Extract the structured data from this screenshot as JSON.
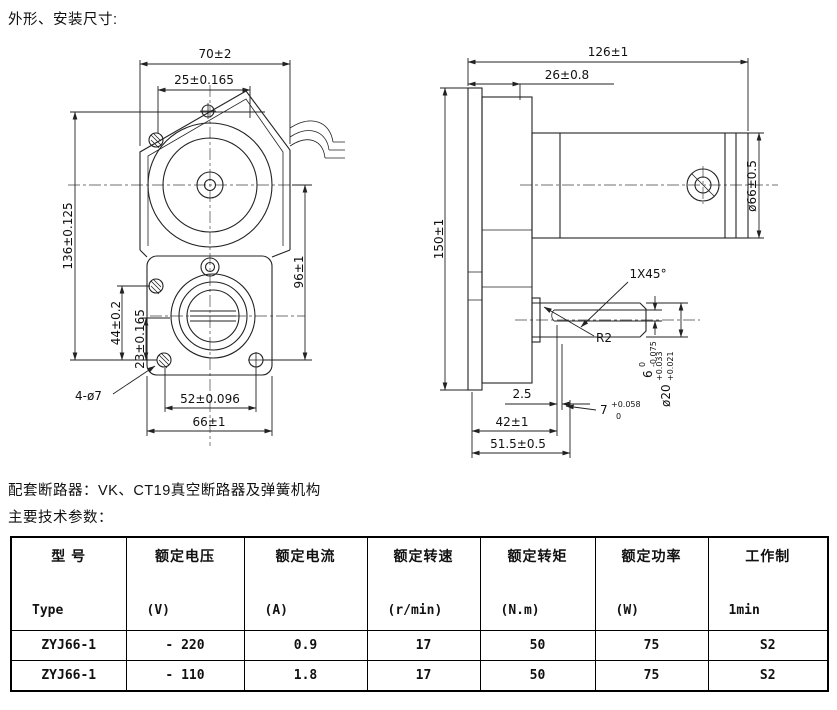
{
  "page": {
    "title": "外形、安装尺寸:",
    "breaker_note": "配套断路器：VK、CT19真空断路器及弹簧机构",
    "params_heading": "主要技术参数："
  },
  "drawing": {
    "front_view": {
      "dim_width_top": "70±2",
      "dim_hole_top": "25±0.165",
      "dim_height": "136±0.125",
      "dim_44": "44±0.2",
      "dim_23": "23±0.165",
      "dim_96": "96±1",
      "holes_note": "4-ø7",
      "dim_52": "52±0.096",
      "dim_66": "66±1"
    },
    "side_view": {
      "dim_length": "126±1",
      "dim_26": "26±0.8",
      "dim_150": "150±1",
      "dim_dia66": "ø66±0.5",
      "chamfer": "1X45°",
      "fillet": "R2",
      "dim_2_5": "2.5",
      "dim_42": "42±1",
      "dim_51_5": "51.5±0.5",
      "key_width": {
        "base": "6",
        "upper": "0",
        "lower": "-0.075"
      },
      "shaft_dia": {
        "base": "ø20",
        "upper": "+0.033",
        "lower": "+0.021"
      },
      "key_height": {
        "base": "7",
        "upper": "+0.058",
        "lower": "0"
      }
    }
  },
  "table": {
    "columns": [
      {
        "cn": "型  号",
        "en": "Type"
      },
      {
        "cn": "额定电压",
        "en": "(V)"
      },
      {
        "cn": "额定电流",
        "en": "(A)"
      },
      {
        "cn": "额定转速",
        "en": "(r/min)"
      },
      {
        "cn": "额定转矩",
        "en": "(N.m)"
      },
      {
        "cn": "额定功率",
        "en": "(W)"
      },
      {
        "cn": "工作制",
        "en": "1min"
      }
    ],
    "rows": [
      [
        "ZYJ66-1",
        "- 220",
        "0.9",
        "17",
        "50",
        "75",
        "S2"
      ],
      [
        "ZYJ66-1",
        "- 110",
        "1.8",
        "17",
        "50",
        "75",
        "S2"
      ]
    ]
  }
}
